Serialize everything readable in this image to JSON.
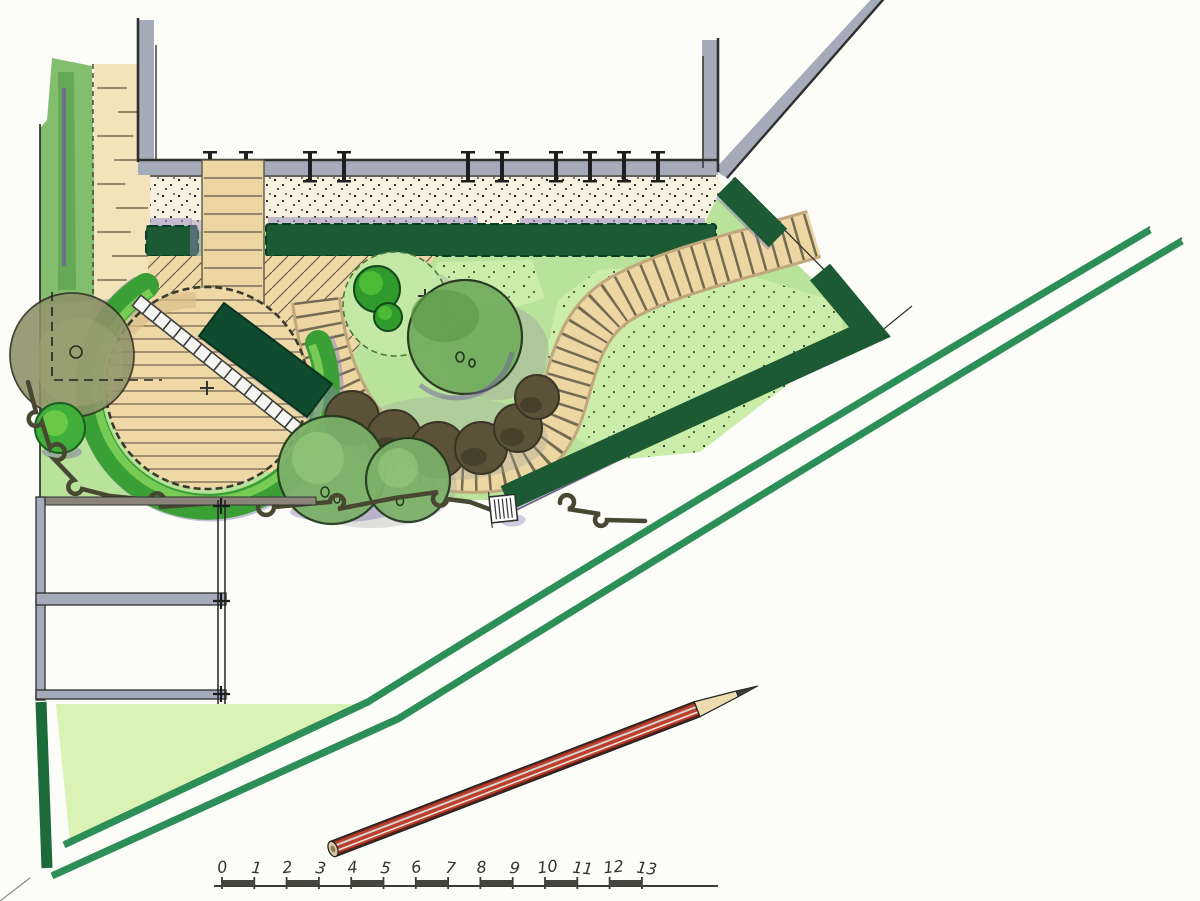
{
  "drawing": {
    "kind": "hand-drawn garden landscape plan",
    "scale_bar": {
      "labels": [
        "0",
        "1",
        "2",
        "3",
        "4",
        "5",
        "6",
        "7",
        "8",
        "9",
        "10",
        "11",
        "12",
        "13"
      ]
    }
  },
  "colors": {
    "paper": "#fcfcf9",
    "wall_gray": "#a6abba",
    "ink": "#1e1e1e",
    "gravel": "#f7f1e0",
    "stone": "#ecd6a2",
    "stone_shadow": "#c0a77c",
    "deck": "#eed9a6",
    "lawn": "#b9e29b",
    "meadow": "#cbeda9",
    "triangle_lawn": "#d9f3b5",
    "strip_green": "#83bd6e",
    "hedge_dark": "#1c5a33",
    "hedge_block": "#0f4c2f",
    "hedge_row": "#2c8f58",
    "arc_green": "#3aa035",
    "arc_light": "#7fd05a",
    "fruit_tree": "#74ae60",
    "tree_pair": "#7cb169",
    "topiary": "#2f9b2c",
    "topiary_light": "#54c13a",
    "olive_tree": "#8e9168",
    "shrub_brown": "#5c523a",
    "bush_green": "#3fae3a",
    "purple_shadow": "#8d7fb5",
    "pencil_red": "#bd3f2c",
    "pencil_wood": "#ecdcb0"
  }
}
